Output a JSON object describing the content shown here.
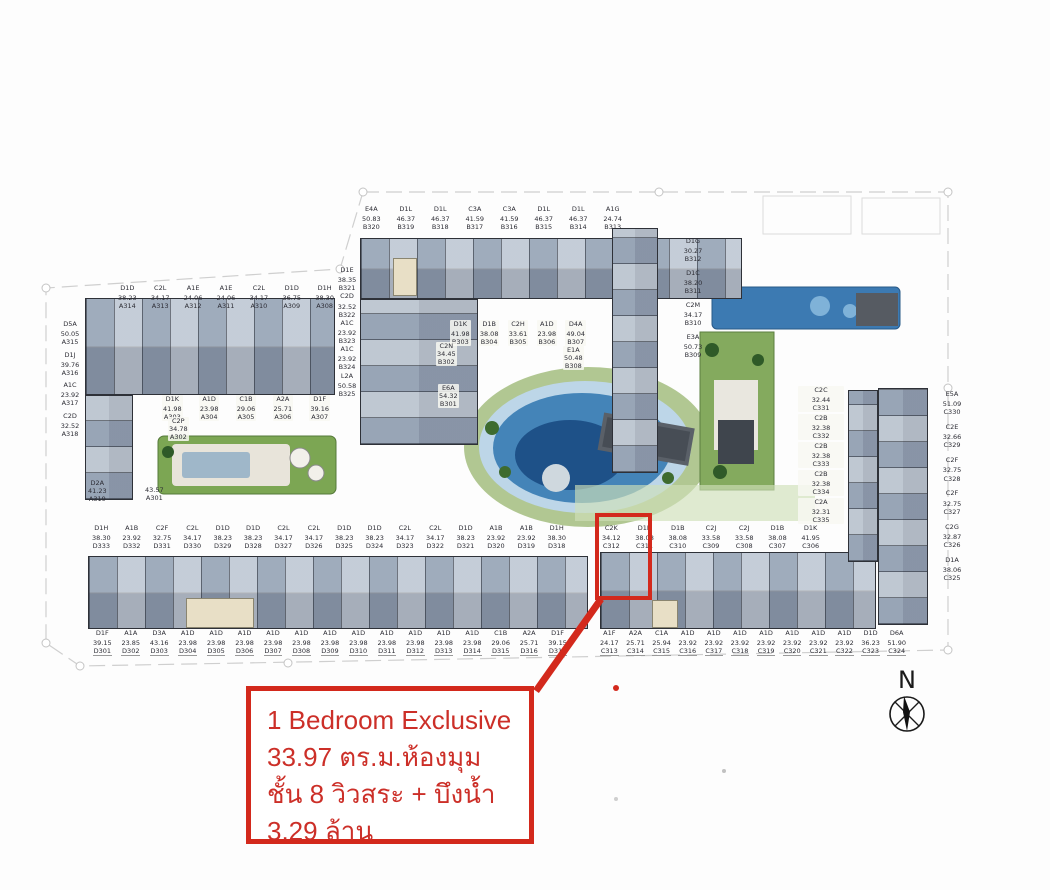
{
  "colors": {
    "accent_red": "#d3291c"
  },
  "annotation": {
    "line1": "1 Bedroom Exclusive",
    "line2": "33.97 ตร.ม.ห้องมุม",
    "line3": "ชั้น 8 วิวสระ + บึงน้ำ",
    "line4": "3.29 ล้าน"
  },
  "compass": {
    "label": "N"
  },
  "highlight": {
    "unit_ref": "C312"
  },
  "building_a": {
    "top_row": [
      {
        "t": "D1D",
        "a": "38.23",
        "u": "A314"
      },
      {
        "t": "C2L",
        "a": "34.17",
        "u": "A313"
      },
      {
        "t": "A1E",
        "a": "24.06",
        "u": "A312"
      },
      {
        "t": "A1E",
        "a": "24.06",
        "u": "A311"
      },
      {
        "t": "C2L",
        "a": "34.17",
        "u": "A310"
      },
      {
        "t": "D1D",
        "a": "36.75",
        "u": "A309"
      },
      {
        "t": "D1H",
        "a": "38.30",
        "u": "A308"
      }
    ],
    "left_col": [
      {
        "t": "D5A",
        "a": "50.05",
        "u": "A315"
      },
      {
        "t": "D1J",
        "a": "39.76",
        "u": "A316"
      },
      {
        "t": "A1C",
        "a": "23.92",
        "u": "A317"
      },
      {
        "t": "C2D",
        "a": "32.52",
        "u": "A318"
      }
    ],
    "inner_row": [
      {
        "t": "D1K",
        "a": "41.98",
        "u": "A303"
      },
      {
        "t": "A1D",
        "a": "23.98",
        "u": "A304"
      },
      {
        "t": "C1B",
        "a": "29.06",
        "u": "A305"
      },
      {
        "t": "A2A",
        "a": "25.71",
        "u": "A306"
      },
      {
        "t": "D1F",
        "a": "39.16",
        "u": "A307"
      }
    ],
    "extra_a302": {
      "t": "C2P",
      "a": "34.78",
      "u": "A302"
    },
    "extra_a319": {
      "t": "D2A",
      "a": "41.23",
      "u": "A319"
    },
    "extra_a301": {
      "t": "",
      "a": "43.57",
      "u": "A301"
    }
  },
  "building_b": {
    "top_row": [
      {
        "t": "E4A",
        "a": "50.83",
        "u": "B320"
      },
      {
        "t": "D1L",
        "a": "46.37",
        "u": "B319"
      },
      {
        "t": "D1L",
        "a": "46.37",
        "u": "B318"
      },
      {
        "t": "C3A",
        "a": "41.59",
        "u": "B317"
      },
      {
        "t": "C3A",
        "a": "41.59",
        "u": "B316"
      },
      {
        "t": "D1L",
        "a": "46.37",
        "u": "B315"
      },
      {
        "t": "D1L",
        "a": "46.37",
        "u": "B314"
      },
      {
        "t": "A1G",
        "a": "24.74",
        "u": "B313"
      }
    ],
    "left_col": [
      {
        "t": "D1E",
        "a": "38.35",
        "u": "B321"
      },
      {
        "t": "C2D",
        "a": "32.52",
        "u": "B322"
      },
      {
        "t": "A1C",
        "a": "23.92",
        "u": "B323"
      },
      {
        "t": "A1C",
        "a": "23.92",
        "u": "B324"
      },
      {
        "t": "L2A",
        "a": "50.58",
        "u": "B325"
      }
    ],
    "mid_row": [
      {
        "t": "D1K",
        "a": "41.98",
        "u": "B303"
      },
      {
        "t": "D1B",
        "a": "38.08",
        "u": "B304"
      },
      {
        "t": "C2H",
        "a": "33.61",
        "u": "B305"
      },
      {
        "t": "A1D",
        "a": "23.98",
        "u": "B306"
      },
      {
        "t": "D4A",
        "a": "49.04",
        "u": "B307"
      }
    ],
    "extra_b302": {
      "t": "C2N",
      "a": "34.45",
      "u": "B302"
    },
    "extra_b301": {
      "t": "E6A",
      "a": "54.32",
      "u": "B301"
    },
    "extra_b308": {
      "t": "E1A",
      "a": "50.48",
      "u": "B308"
    },
    "right_col": [
      {
        "t": "D1G",
        "a": "30.27",
        "u": "B312"
      },
      {
        "t": "D1C",
        "a": "38.20",
        "u": "B311"
      },
      {
        "t": "C2M",
        "a": "34.17",
        "u": "B310"
      },
      {
        "t": "E3A",
        "a": "50.73",
        "u": "B309"
      }
    ]
  },
  "building_d": {
    "top_row": [
      {
        "t": "D1H",
        "a": "38.30",
        "u": "D333"
      },
      {
        "t": "A1B",
        "a": "23.92",
        "u": "D332"
      },
      {
        "t": "C2F",
        "a": "32.75",
        "u": "D331"
      },
      {
        "t": "C2L",
        "a": "34.17",
        "u": "D330"
      },
      {
        "t": "D1D",
        "a": "38.23",
        "u": "D329"
      },
      {
        "t": "D1D",
        "a": "38.23",
        "u": "D328"
      },
      {
        "t": "C2L",
        "a": "34.17",
        "u": "D327"
      },
      {
        "t": "C2L",
        "a": "34.17",
        "u": "D326"
      },
      {
        "t": "D1D",
        "a": "38.23",
        "u": "D325"
      },
      {
        "t": "D1D",
        "a": "38.23",
        "u": "D324"
      },
      {
        "t": "C2L",
        "a": "34.17",
        "u": "D323"
      },
      {
        "t": "C2L",
        "a": "34.17",
        "u": "D322"
      },
      {
        "t": "D1D",
        "a": "38.23",
        "u": "D321"
      },
      {
        "t": "A1B",
        "a": "23.92",
        "u": "D320"
      },
      {
        "t": "A1B",
        "a": "23.92",
        "u": "D319"
      },
      {
        "t": "D1H",
        "a": "38.30",
        "u": "D318"
      }
    ],
    "bottom_row": [
      {
        "t": "D1F",
        "a": "39.15",
        "u": "D301"
      },
      {
        "t": "A1A",
        "a": "23.85",
        "u": "D302"
      },
      {
        "t": "D3A",
        "a": "43.16",
        "u": "D303"
      },
      {
        "t": "A1D",
        "a": "23.98",
        "u": "D304"
      },
      {
        "t": "A1D",
        "a": "23.98",
        "u": "D305"
      },
      {
        "t": "A1D",
        "a": "23.98",
        "u": "D306"
      },
      {
        "t": "A1D",
        "a": "23.98",
        "u": "D307"
      },
      {
        "t": "A1D",
        "a": "23.98",
        "u": "D308"
      },
      {
        "t": "A1D",
        "a": "23.98",
        "u": "D309"
      },
      {
        "t": "A1D",
        "a": "23.98",
        "u": "D310"
      },
      {
        "t": "A1D",
        "a": "23.98",
        "u": "D311"
      },
      {
        "t": "A1D",
        "a": "23.98",
        "u": "D312"
      },
      {
        "t": "A1D",
        "a": "23.98",
        "u": "D313"
      },
      {
        "t": "A1D",
        "a": "23.98",
        "u": "D314"
      },
      {
        "t": "C1B",
        "a": "29.06",
        "u": "D315"
      },
      {
        "t": "A2A",
        "a": "25.71",
        "u": "D316"
      },
      {
        "t": "D1F",
        "a": "39.15",
        "u": "D317"
      }
    ]
  },
  "building_c": {
    "top_row": [
      {
        "t": "C2K",
        "a": "34.12",
        "u": "C312"
      },
      {
        "t": "D1B",
        "a": "38.08",
        "u": "C311"
      },
      {
        "t": "D1B",
        "a": "38.08",
        "u": "C310"
      },
      {
        "t": "C2J",
        "a": "33.58",
        "u": "C309"
      },
      {
        "t": "C2J",
        "a": "33.58",
        "u": "C308"
      },
      {
        "t": "D1B",
        "a": "38.08",
        "u": "C307"
      },
      {
        "t": "D1K",
        "a": "41.95",
        "u": "C306"
      }
    ],
    "bottom_row": [
      {
        "t": "A1F",
        "a": "24.17",
        "u": "C313"
      },
      {
        "t": "A2A",
        "a": "25.71",
        "u": "C314"
      },
      {
        "t": "C1A",
        "a": "25.94",
        "u": "C315"
      },
      {
        "t": "A1D",
        "a": "23.92",
        "u": "C316"
      },
      {
        "t": "A1D",
        "a": "23.92",
        "u": "C317"
      },
      {
        "t": "A1D",
        "a": "23.92",
        "u": "C318"
      },
      {
        "t": "A1D",
        "a": "23.92",
        "u": "C319"
      },
      {
        "t": "A1D",
        "a": "23.92",
        "u": "C320"
      },
      {
        "t": "A1D",
        "a": "23.92",
        "u": "C321"
      },
      {
        "t": "A1D",
        "a": "23.92",
        "u": "C322"
      },
      {
        "t": "D1D",
        "a": "36.23",
        "u": "C323"
      },
      {
        "t": "D6A",
        "a": "51.90",
        "u": "C324"
      }
    ],
    "right_col": [
      {
        "t": "E5A",
        "a": "51.09",
        "u": "C330"
      },
      {
        "t": "C2E",
        "a": "32.66",
        "u": "C329"
      },
      {
        "t": "C2F",
        "a": "32.75",
        "u": "C328"
      },
      {
        "t": "C2F",
        "a": "32.75",
        "u": "C327"
      },
      {
        "t": "C2G",
        "a": "32.87",
        "u": "C326"
      },
      {
        "t": "D1A",
        "a": "38.06",
        "u": "C325"
      }
    ],
    "inner_col": [
      {
        "t": "C2C",
        "a": "32.44",
        "u": "C331"
      },
      {
        "t": "C2B",
        "a": "32.38",
        "u": "C332"
      },
      {
        "t": "C2B",
        "a": "32.38",
        "u": "C333"
      },
      {
        "t": "C2B",
        "a": "32.38",
        "u": "C334"
      },
      {
        "t": "C2A",
        "a": "32.31",
        "u": "C335"
      }
    ]
  }
}
